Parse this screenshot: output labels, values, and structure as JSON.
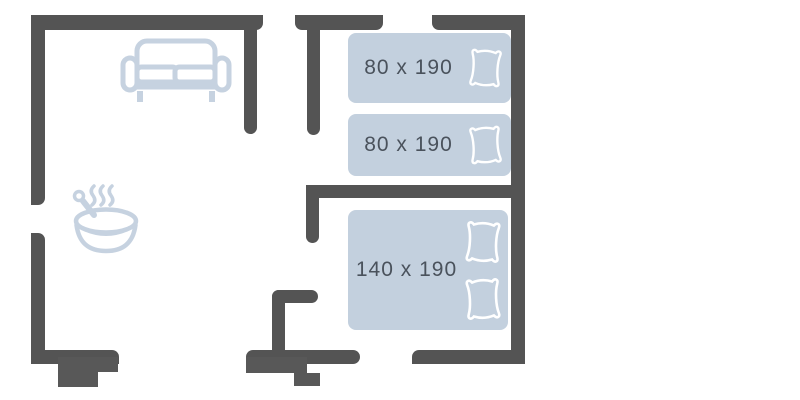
{
  "floor_plan": {
    "beds": [
      {
        "id": "single-1",
        "type": "single",
        "size_label": "80 x 190",
        "pillows": 1
      },
      {
        "id": "single-2",
        "type": "single",
        "size_label": "80 x 190",
        "pillows": 1
      },
      {
        "id": "double-1",
        "type": "double",
        "size_label": "140 x 190",
        "pillows": 2
      }
    ],
    "furniture_icons": [
      "sofa-icon",
      "frying-pan-icon",
      "steam-icon",
      "pillow-icon"
    ],
    "colors": {
      "wall": "#545454",
      "bed_fill": "#c3d0de",
      "furniture_stroke": "#c6d2e0",
      "pillow_stroke": "#ffffff",
      "label_text": "#4a525c"
    }
  }
}
